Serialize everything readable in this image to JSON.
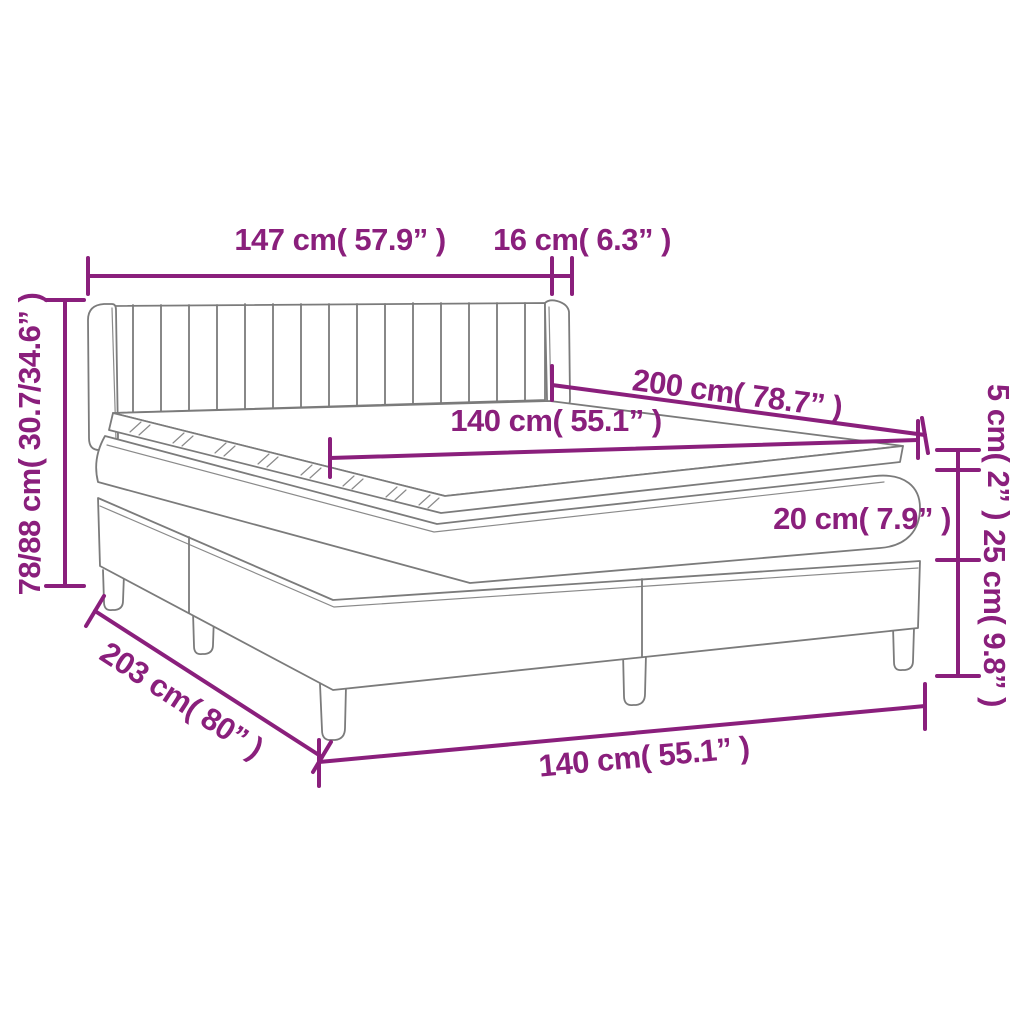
{
  "meta": {
    "diagram_type": "product-dimension-diagram",
    "product": "box-spring-bed-with-headboard-and-topper",
    "accent_color": "#8a1f7c",
    "line_color": "#7b7b7b",
    "background_color": "#ffffff"
  },
  "labels": {
    "headboard_width": "147 cm( 57.9” )",
    "headboard_depth": "16 cm( 6.3” )",
    "headboard_height": "78/88 cm( 30.7/34.6” )",
    "bed_length": "200 cm( 78.7” )",
    "mattress_width": "140 cm( 55.1” )",
    "topper_thickness": "5 cm( 2” )",
    "mattress_thickness": "20 cm( 7.9” )",
    "base_height": "25 cm( 9.8” )",
    "total_length": "203 cm( 80” )",
    "base_width": "140 cm( 55.1” )"
  }
}
